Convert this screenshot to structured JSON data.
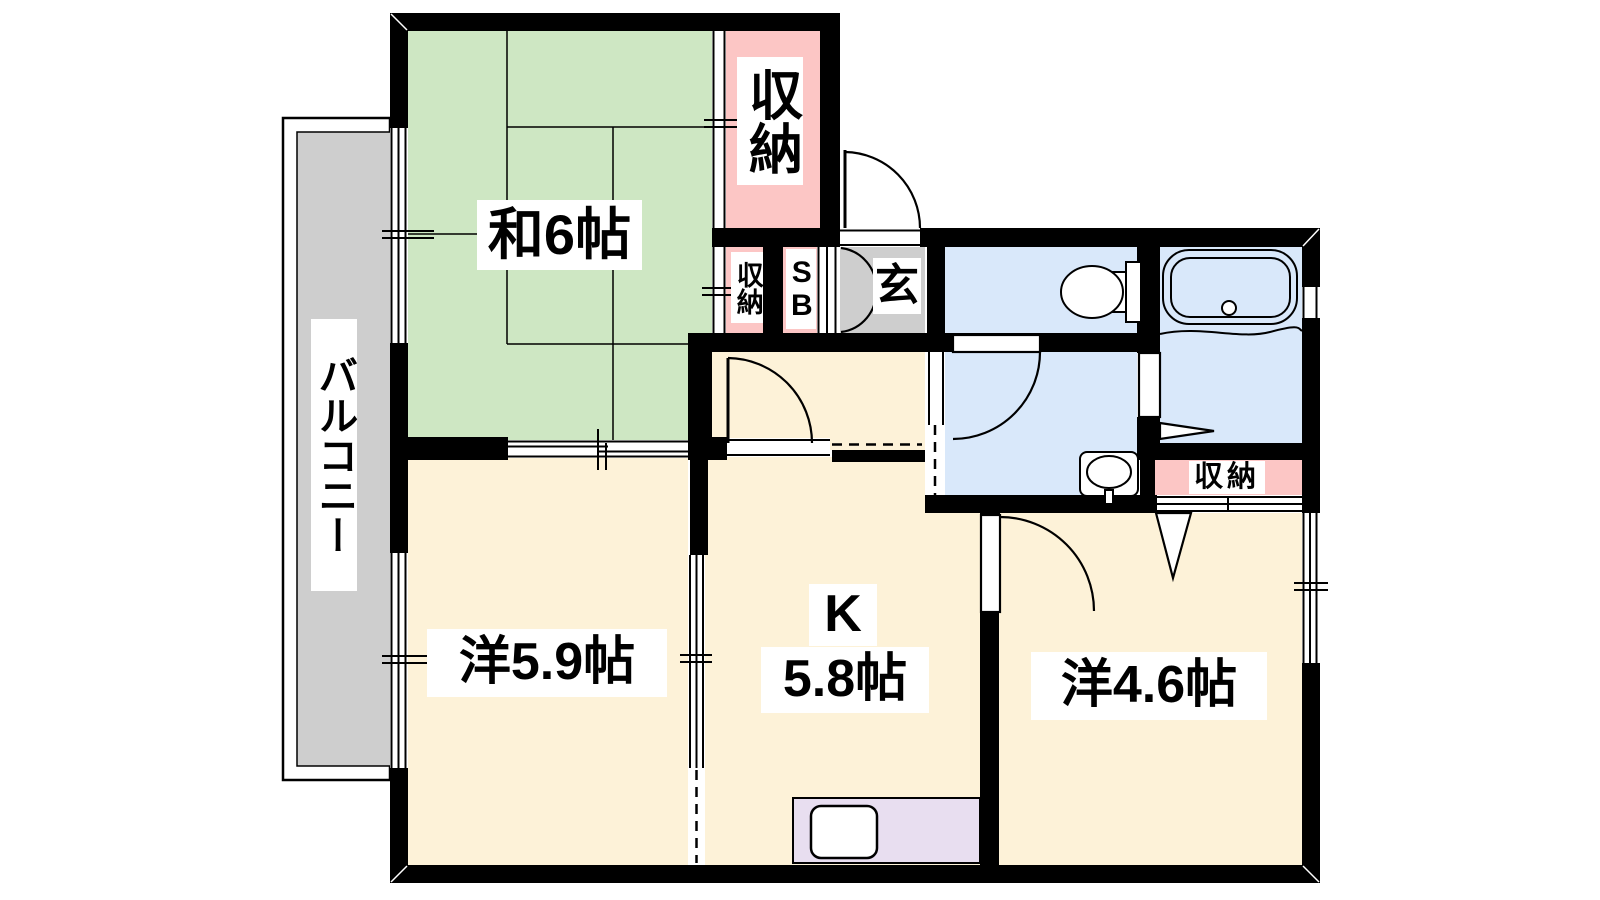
{
  "floorplan": {
    "kind": "apartment-floor-plan",
    "labels": {
      "japanese_room": "和6帖",
      "closet_top": "収納",
      "closet_hall": "収納",
      "shoe_box": "SB",
      "entrance": "玄",
      "balcony": "バルコニー",
      "western_room_large": "洋5.9帖",
      "kitchen_letter": "K",
      "kitchen_size": "5.8帖",
      "western_room_small": "洋4.6帖",
      "closet_bedroom": "収納"
    },
    "rooms": [
      {
        "label": "和6帖",
        "fill": "tatami"
      },
      {
        "label": "収納",
        "fill": "storage"
      },
      {
        "label": "収納",
        "fill": "storage"
      },
      {
        "label": "SB",
        "fill": "storage"
      },
      {
        "label": "玄",
        "fill": "entry"
      },
      {
        "label": "バルコニー",
        "fill": "entry"
      },
      {
        "label": "洋5.9帖",
        "fill": "flooring"
      },
      {
        "label": "K 5.8帖",
        "fill": "flooring"
      },
      {
        "label": "洋4.6帖",
        "fill": "flooring"
      },
      {
        "label": "収納",
        "fill": "storage"
      }
    ],
    "fixtures": [
      "toilet-icon",
      "bathtub-icon",
      "washbasin-icon",
      "kitchen-sink-icon"
    ],
    "colors": {
      "tatami": "#cee7c3",
      "storage": "#fcc6c5",
      "flooring": "#fdf2d8",
      "wet": "#d9e8fa",
      "entry": "#cecece",
      "counter": "#e8def0",
      "wall": "#000000",
      "white": "#ffffff"
    }
  }
}
